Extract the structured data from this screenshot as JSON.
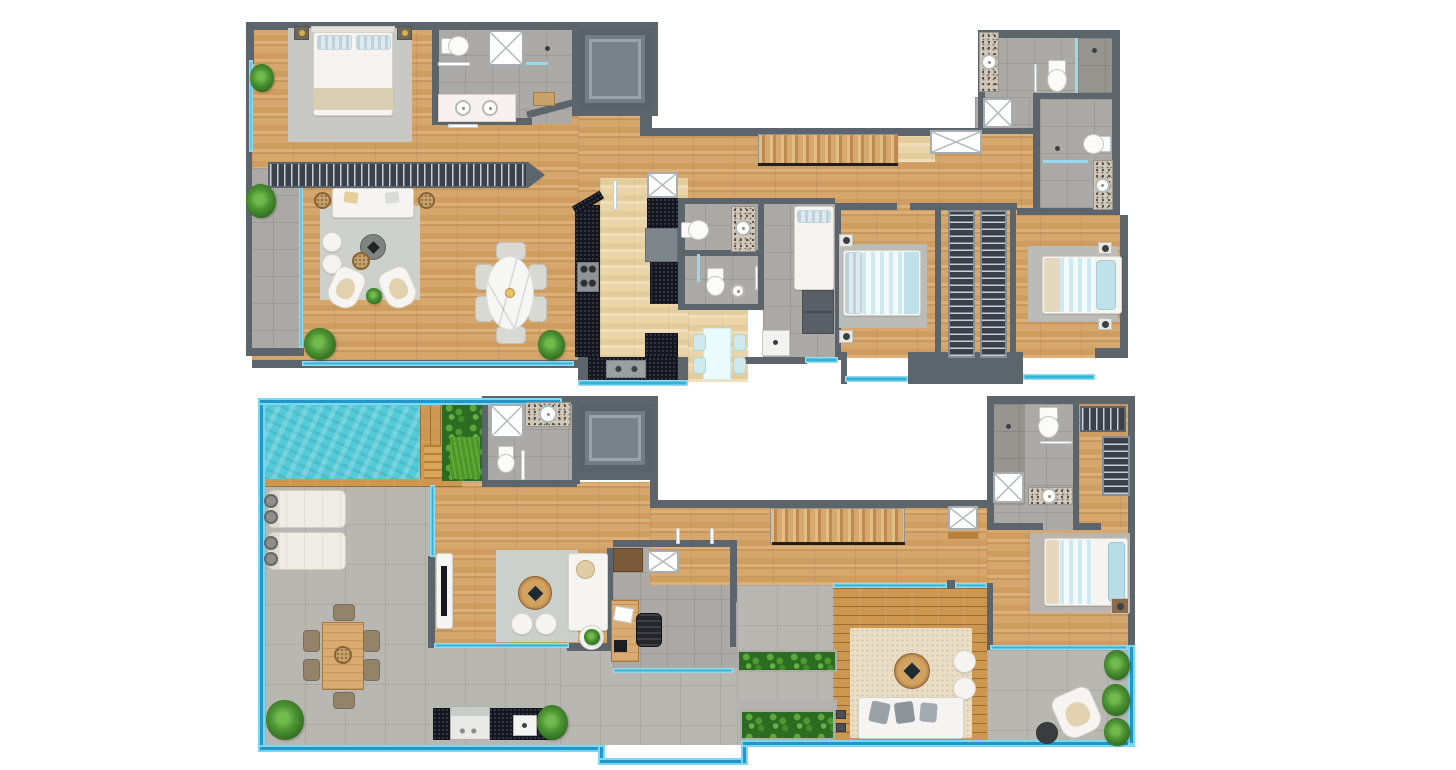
{
  "image": {
    "type": "architectural-floor-plan-render",
    "view": "top-down",
    "floors_shown": 2,
    "background": "#ffffff",
    "text_labels": "none"
  },
  "palette": {
    "wall": "#5c656c",
    "wood": "#d5a468",
    "wood_pale": "#ecd9ae",
    "tile": "#abaaa6",
    "terrace_tile": "#b9b7b2",
    "glass": "#2fb4da",
    "pool": "#55cbd8",
    "deck": "#cd9750",
    "hedge": "#2e6b22",
    "rug_gray": "#cbcec9",
    "rug_warm": "#eadfc6",
    "counter_dark": "#14161f",
    "granite": "#cfc8bb",
    "closet": "#3a414a",
    "furniture_white": "#f5f4f0",
    "bedding_blue": "#bfe2ea",
    "stair_wood": "#c9935c"
  },
  "floors": [
    {
      "name": "upper-level-plan",
      "rooms": [
        {
          "name": "master-bedroom",
          "furniture": [
            "double-bed",
            "pillows",
            "rug",
            "nightstands",
            "wardrobe-rail"
          ]
        },
        {
          "name": "master-bathroom",
          "furniture": [
            "toilet",
            "shower",
            "double-vanity",
            "bench",
            "towel-rack"
          ]
        },
        {
          "name": "elevator"
        },
        {
          "name": "living-room",
          "furniture": [
            "sofa",
            "two-armchairs",
            "coffee-tables",
            "poufs",
            "rug",
            "side-tables",
            "plants"
          ]
        },
        {
          "name": "dining-area",
          "furniture": [
            "oval-marble-table",
            "six-chairs",
            "plant"
          ]
        },
        {
          "name": "kitchen",
          "furniture": [
            "galley-counters",
            "stove",
            "fridge",
            "double-sink",
            "skylight"
          ]
        },
        {
          "name": "breakfast-nook",
          "furniture": [
            "table",
            "four-chairs"
          ]
        },
        {
          "name": "guest-bathroom",
          "furniture": [
            "toilet",
            "vanity-sink"
          ]
        },
        {
          "name": "powder-room",
          "furniture": [
            "toilet",
            "sink"
          ]
        },
        {
          "name": "utility-room",
          "furniture": [
            "single-bed",
            "cabinet",
            "laundry-sink"
          ]
        },
        {
          "name": "bedroom-2",
          "furniture": [
            "double-bed",
            "rug",
            "nightstands"
          ]
        },
        {
          "name": "walk-in-closet",
          "furniture": [
            "two-hanging-rails"
          ]
        },
        {
          "name": "bedroom-3",
          "furniture": [
            "double-bed",
            "rug",
            "nightstands"
          ]
        },
        {
          "name": "bathroom-2",
          "furniture": [
            "toilet",
            "vanity-sink",
            "shower"
          ]
        },
        {
          "name": "bathroom-3",
          "furniture": [
            "toilet",
            "vanity-sink",
            "shower"
          ]
        },
        {
          "name": "staircase"
        },
        {
          "name": "side-terrace",
          "furniture": [
            "plants"
          ]
        },
        {
          "name": "balconies",
          "furniture": [
            "glass-railings"
          ]
        }
      ]
    },
    {
      "name": "lower-level-roof-terrace-plan",
      "rooms": [
        {
          "name": "swimming-pool"
        },
        {
          "name": "pool-deck",
          "furniture": [
            "steps"
          ]
        },
        {
          "name": "garden-hedge"
        },
        {
          "name": "pool-bathroom",
          "furniture": [
            "shower",
            "toilet",
            "vanity-sink"
          ]
        },
        {
          "name": "elevator"
        },
        {
          "name": "sun-terrace",
          "furniture": [
            "two-sun-loungers",
            "outdoor-dining-table",
            "six-chairs",
            "plants"
          ]
        },
        {
          "name": "family-room",
          "furniture": [
            "sofa",
            "round-coffee-table",
            "poufs",
            "rug",
            "tv-console",
            "side-table"
          ]
        },
        {
          "name": "study",
          "furniture": [
            "desk",
            "office-chair",
            "shelf",
            "skylight"
          ]
        },
        {
          "name": "staircase"
        },
        {
          "name": "bedroom",
          "furniture": [
            "double-bed",
            "rug",
            "nightstand"
          ]
        },
        {
          "name": "bathroom",
          "furniture": [
            "shower",
            "toilet",
            "vanity-sink"
          ]
        },
        {
          "name": "walk-in-closet",
          "furniture": [
            "hanging-rails"
          ]
        },
        {
          "name": "wood-deck-lounge",
          "furniture": [
            "outdoor-sofa",
            "round-table",
            "poufs",
            "outdoor-rug",
            "speakers"
          ]
        },
        {
          "name": "reading-corner",
          "furniture": [
            "armchair",
            "side-table"
          ]
        },
        {
          "name": "bbq-counter",
          "furniture": [
            "grill",
            "sink",
            "plant"
          ]
        },
        {
          "name": "planters",
          "furniture": [
            "greenery"
          ]
        }
      ]
    }
  ]
}
